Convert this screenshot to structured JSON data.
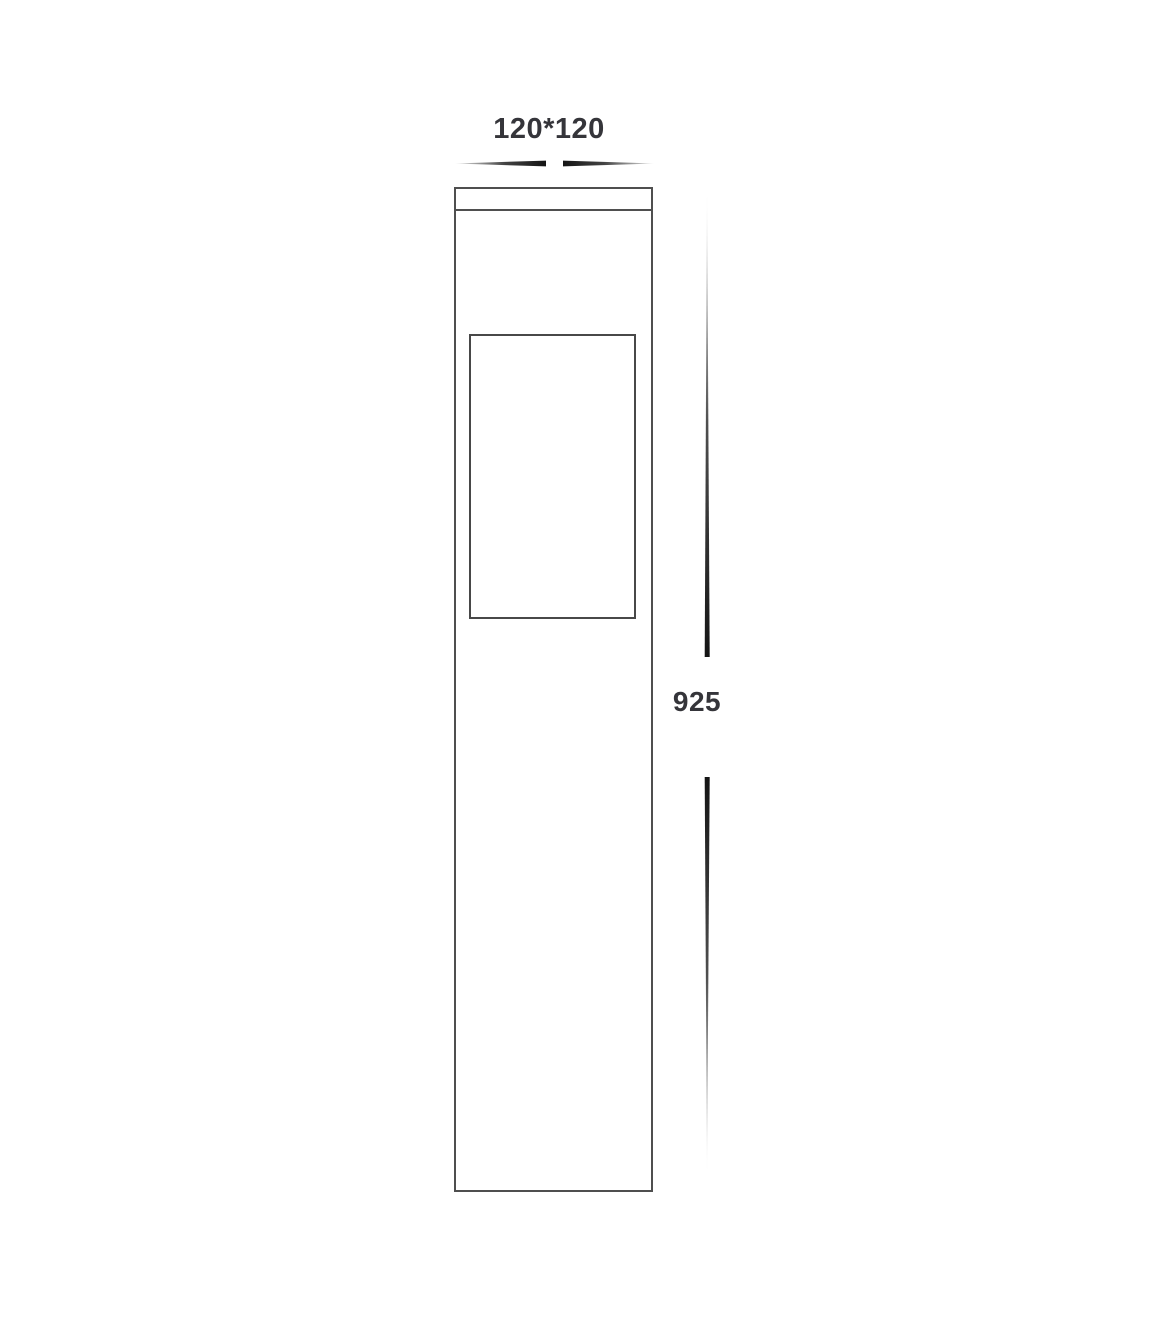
{
  "diagram": {
    "width_dimension_label": "120*120",
    "height_dimension_label": "925"
  },
  "colors": {
    "background": "#ffffff",
    "outline": "#4f4f4f",
    "window_outline": "#484848",
    "arrow": "#141414",
    "label_text": "#35353a"
  }
}
